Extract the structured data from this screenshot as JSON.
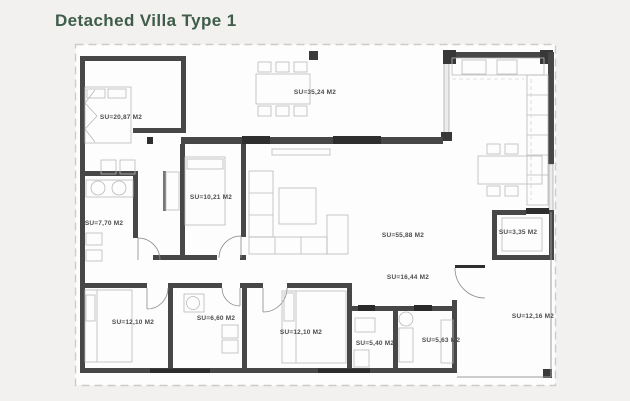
{
  "page": {
    "title": "Detached Villa Type 1"
  },
  "colors": {
    "title_green": "#3e5c49",
    "wall_dark": "#474747",
    "door_dark": "#2e2e2e",
    "furniture_gray": "#b8b8b8",
    "label_gray": "#4d4d4d",
    "paper": "#fdfdfd",
    "background": "#f2f1ef"
  },
  "floorplan": {
    "area_unit": "M2",
    "rooms": [
      {
        "name": "bedroom-top-left",
        "area_label": "SU=20,87 M2"
      },
      {
        "name": "dining-terrace-top",
        "area_label": "SU=35,24 M2"
      },
      {
        "name": "bedroom-middle",
        "area_label": "SU=10,21 M2"
      },
      {
        "name": "bathroom-left",
        "area_label": "SU=7,70 M2"
      },
      {
        "name": "living-room",
        "area_label": "SU=55,88 M2"
      },
      {
        "name": "storage-right",
        "area_label": "SU=3,35 M2"
      },
      {
        "name": "corridor",
        "area_label": "SU=16,44 M2"
      },
      {
        "name": "bedroom-bottom-left",
        "area_label": "SU=12,10 M2"
      },
      {
        "name": "bathroom-middle",
        "area_label": "SU=6,60 M2"
      },
      {
        "name": "bedroom-bottom-center",
        "area_label": "SU=12,10 M2"
      },
      {
        "name": "bathroom-small-left",
        "area_label": "SU=5,40 M2"
      },
      {
        "name": "bathroom-small-right",
        "area_label": "SU=5,63 M2"
      },
      {
        "name": "terrace-right",
        "area_label": "SU=12,16 M2"
      }
    ]
  }
}
